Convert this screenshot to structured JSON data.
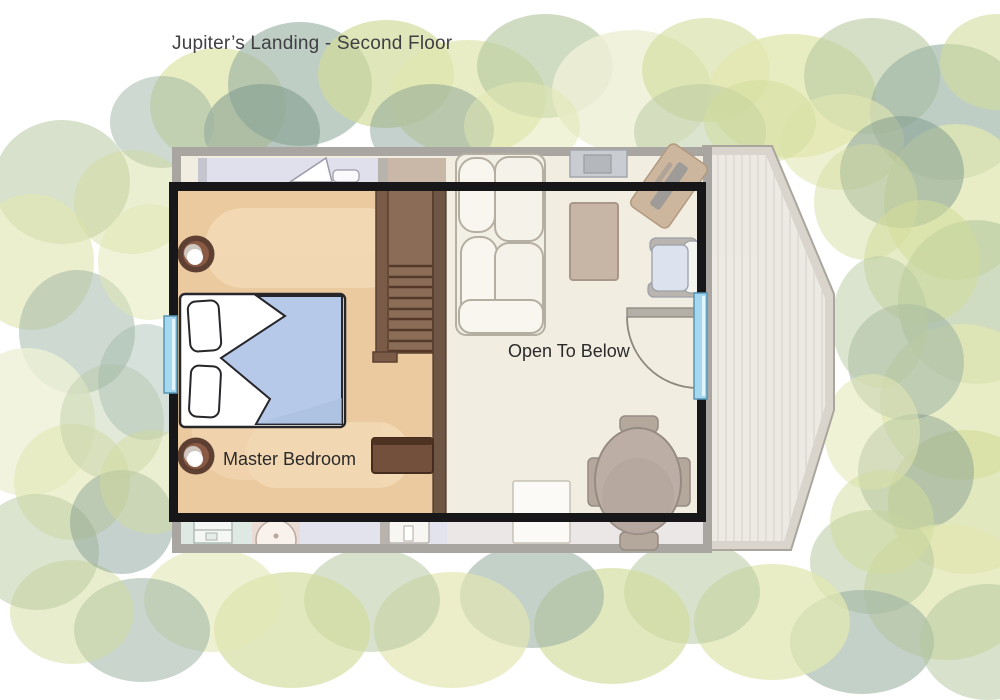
{
  "title": "Jupiter’s Landing - Second Floor",
  "floor_plan": {
    "property": "Jupiter’s Landing",
    "floor": "Second Floor",
    "rooms": [
      {
        "name": "master-bedroom",
        "label": "Master Bedroom"
      },
      {
        "name": "open-to-below",
        "label": "Open To Below"
      }
    ],
    "features": [
      "staircase",
      "bed",
      "dresser",
      "plant-pots",
      "deck",
      "door-swing",
      "windows"
    ]
  },
  "colors": {
    "wall": "#17171a",
    "interior_wall": "#6f5544",
    "bedroom_floor": "#ecca9f",
    "bedroom_floor_light": "#f4dab7",
    "first_floor_ghost": "#f1ede1",
    "stairs": "#8a6c57",
    "blanket": "#b7c9e9",
    "window": "#a5d8ef",
    "deck": "#eceae3",
    "deck_edge": "#d9d5cd",
    "footprint_outline": "#a9a5a0",
    "title_text": "#3f3f44",
    "label_text": "#2a2a2a",
    "tree_palette": [
      "#eef0d6",
      "#e2e7b2",
      "#d2dc9b",
      "#b7c9a0",
      "#9cb3a4",
      "#7e998e"
    ]
  }
}
